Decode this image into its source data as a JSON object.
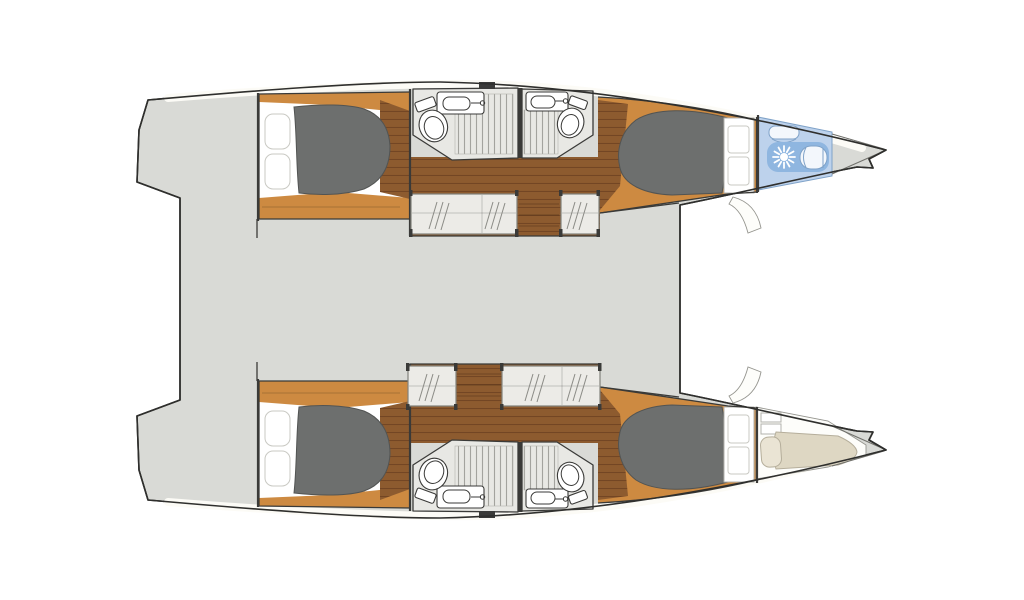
{
  "plan": {
    "label": "Catamaran deck plan",
    "orientation": "bow-right",
    "hulls": 2,
    "guest_cabins": 4,
    "bathrooms": 4,
    "wardrobes": 4,
    "bow_compartments": 2,
    "fixtures": {
      "double_berths": 4,
      "single_berths": 1,
      "toilets": 5,
      "showers": 5,
      "sinks": 5
    },
    "rooms": [
      {
        "id": "port-aft-cabin",
        "name": "Port aft double cabin"
      },
      {
        "id": "port-aft-bathroom",
        "name": "Port aft bathroom with shower"
      },
      {
        "id": "port-fwd-bathroom",
        "name": "Port forward bathroom with shower"
      },
      {
        "id": "port-fwd-cabin",
        "name": "Port forward double cabin"
      },
      {
        "id": "port-bow-head",
        "name": "Port bow wet head"
      },
      {
        "id": "stbd-aft-cabin",
        "name": "Starboard aft double cabin"
      },
      {
        "id": "stbd-aft-bathroom",
        "name": "Starboard aft bathroom with shower"
      },
      {
        "id": "stbd-fwd-bathroom",
        "name": "Starboard forward bathroom with shower"
      },
      {
        "id": "stbd-fwd-cabin",
        "name": "Starboard forward double cabin"
      },
      {
        "id": "stbd-bow-berth",
        "name": "Starboard bow skipper berth"
      },
      {
        "id": "bridge-deck",
        "name": "Central bridge deck"
      },
      {
        "id": "stern-platforms",
        "name": "Stern transom platforms"
      }
    ]
  },
  "colors": {
    "deck": "#d9dad6",
    "outline": "#2f2f2d",
    "band": "#fcfbf6",
    "lineDark": "#3a3a38",
    "wood": "#8d5b2f",
    "woodLine": "#734624",
    "platform": "#cd8a41",
    "mattress": "#6d6f6e",
    "mattressEdge": "#525453",
    "pillow": "#ffffff",
    "pillowStroke": "#c9c9c3",
    "bathFloor": "#e8e8e4",
    "grateLine": "#a3a39e",
    "wardrobe": "#ecebe7",
    "wardrobeStroke": "#82827c",
    "hatchLine": "#8b8b86",
    "blueFloor": "#bdd2ec",
    "blueDeep": "#8fb6e0",
    "blueFixture": "#f3f7fc",
    "blueStroke": "#7fa2c8",
    "berth": "#ded7c3",
    "berthStroke": "#b5ae9b",
    "pillowBeige": "#eae4d4",
    "whiteArea": "#fdfdfa",
    "whiteAreaStroke": "#95958f",
    "shelfStroke": "#b2b2ac"
  }
}
